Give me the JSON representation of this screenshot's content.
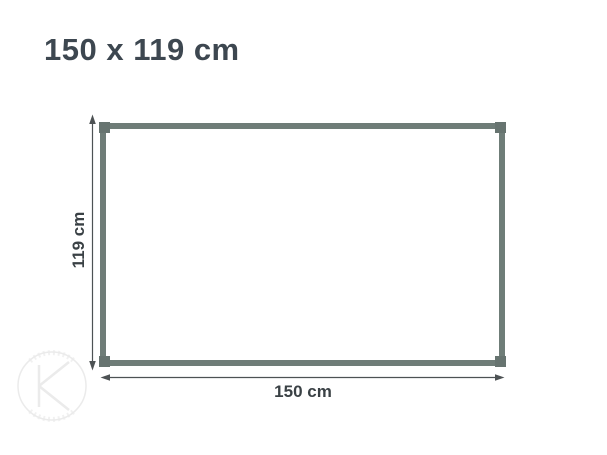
{
  "title": {
    "text": "150 x 119 cm"
  },
  "diagram": {
    "height_label": "119 cm",
    "width_label": "150 cm"
  },
  "watermark": {
    "letter": "K"
  },
  "colors": {
    "bg": "#ffffff",
    "title": "#3d4750",
    "label": "#3a4145",
    "frame": "#6f7d78",
    "frame_corner": "#677470",
    "arrow": "#4d5254",
    "watermark": "#ebebeb"
  }
}
